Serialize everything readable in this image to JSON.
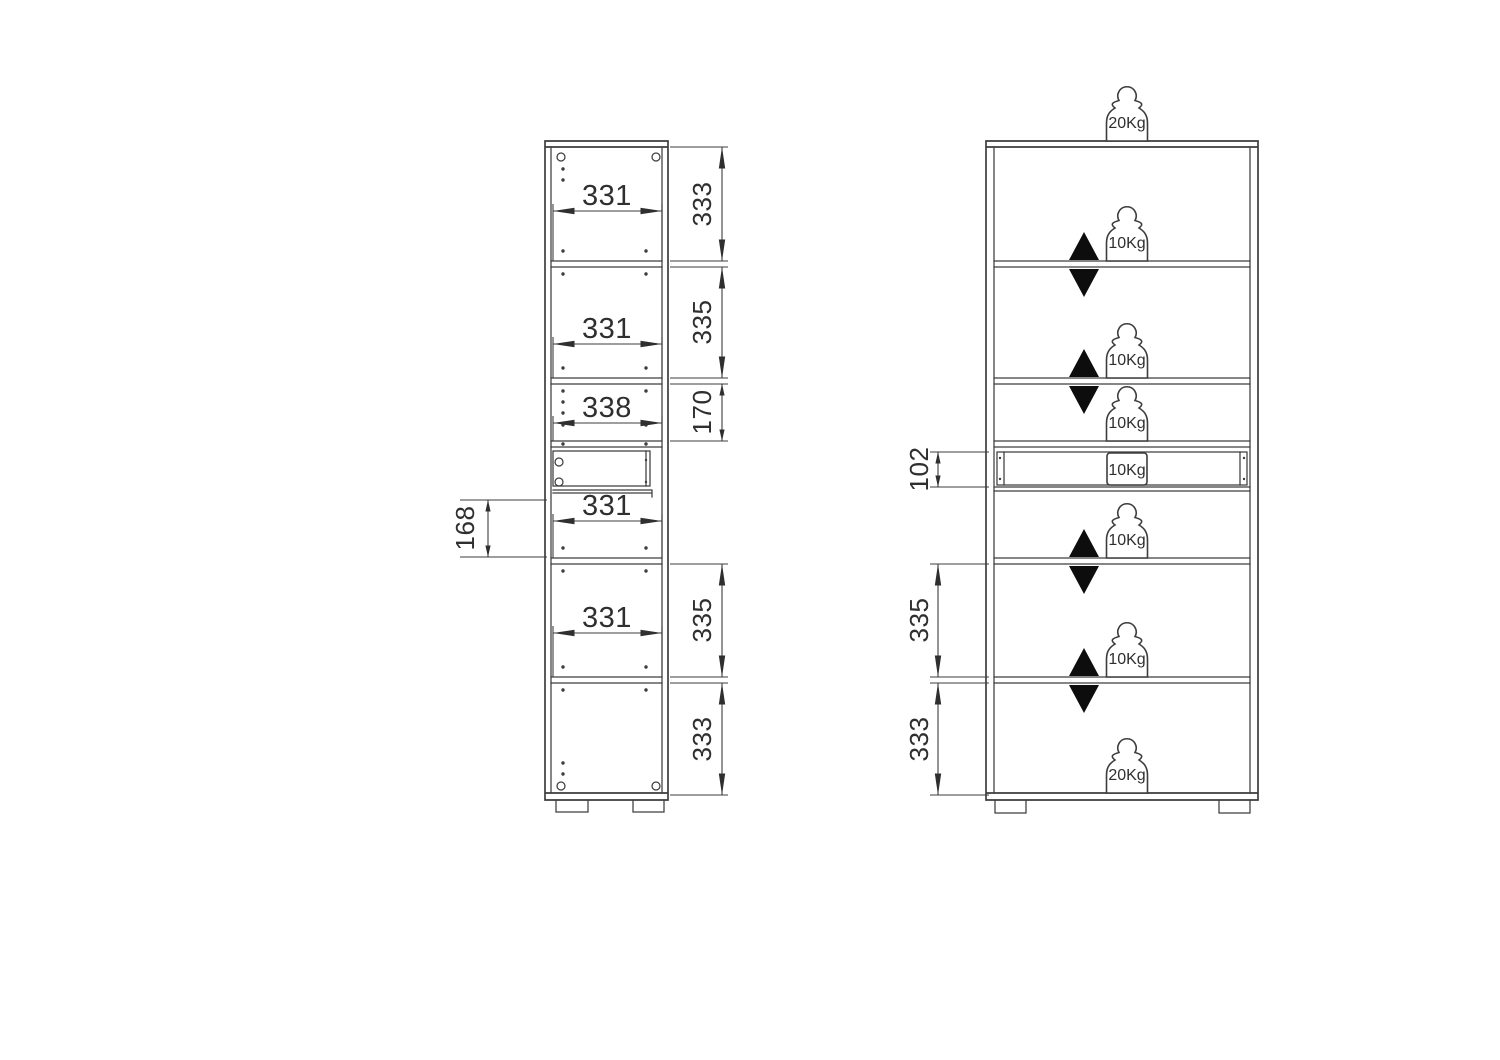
{
  "drawing": {
    "colors": {
      "background": "#ffffff",
      "line": "#3d3d3d",
      "dimension_text": "#2f2f2f",
      "arrow_fill": "#0d0d0d"
    },
    "left_view": {
      "width_dims": [
        {
          "label": "331"
        },
        {
          "label": "331"
        },
        {
          "label": "338"
        },
        {
          "label": "331"
        },
        {
          "label": "331"
        }
      ],
      "height_dims": [
        {
          "label": "333"
        },
        {
          "label": "335"
        },
        {
          "label": "170"
        },
        {
          "label": "335"
        },
        {
          "label": "333"
        }
      ],
      "drawer_dim": {
        "label": "168"
      }
    },
    "right_view": {
      "height_dims": [
        {
          "label": "102"
        },
        {
          "label": "335"
        },
        {
          "label": "333"
        }
      ],
      "loads": [
        {
          "label": "20Kg",
          "location": "top"
        },
        {
          "label": "10Kg",
          "location": "shelf-1"
        },
        {
          "label": "10Kg",
          "location": "shelf-2"
        },
        {
          "label": "10Kg",
          "location": "fixed-shelf"
        },
        {
          "label": "10Kg",
          "location": "drawer"
        },
        {
          "label": "10Kg",
          "location": "shelf-3"
        },
        {
          "label": "10Kg",
          "location": "shelf-4"
        },
        {
          "label": "20Kg",
          "location": "bottom"
        }
      ]
    }
  }
}
